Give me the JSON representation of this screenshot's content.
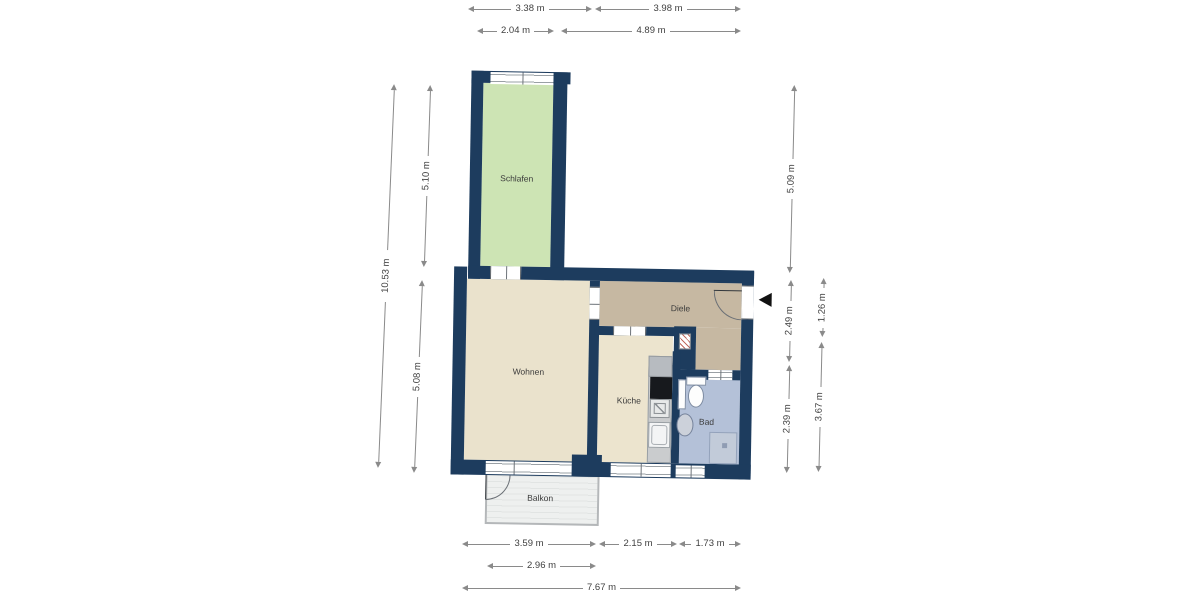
{
  "meta": {
    "type": "apartment-floor-plan"
  },
  "rooms": {
    "schlafen": "Schlafen",
    "wohnen": "Wohnen",
    "diele": "Diele",
    "kueche": "Küche",
    "bad": "Bad",
    "balkon": "Balkon"
  },
  "dimensions": {
    "top_row1_left": "3.38 m",
    "top_row1_right": "3.98 m",
    "top_row2_left": "2.04 m",
    "top_row2_right": "4.89 m",
    "left_total": "10.53 m",
    "left_upper": "5.10 m",
    "left_lower": "5.08 m",
    "right_upper": "5.09 m",
    "right_mid": "2.49 m",
    "right_lower": "2.39 m",
    "right_inner_upper": "1.26 m",
    "right_inner_lower": "3.67 m",
    "bottom_row1_a": "3.59 m",
    "bottom_row1_b": "2.15 m",
    "bottom_row1_c": "1.73 m",
    "bottom_row2": "2.96 m",
    "bottom_total": "7.67 m"
  },
  "colors": {
    "wall": "#1d3c5e",
    "schlafen_floor": "#cde4b4",
    "wohnen_floor": "#eae2cc",
    "diele_floor": "#c6b8a2",
    "kueche_floor": "#ece4ce",
    "bad_floor": "#b4c1d8",
    "balkon_floor": "#eef0ef",
    "dimension_line": "#8a8a8a",
    "dimension_text": "#3f3f3f",
    "entrance_marker": "#121212"
  },
  "icons": {
    "entrance": "entrance-arrow-icon"
  }
}
